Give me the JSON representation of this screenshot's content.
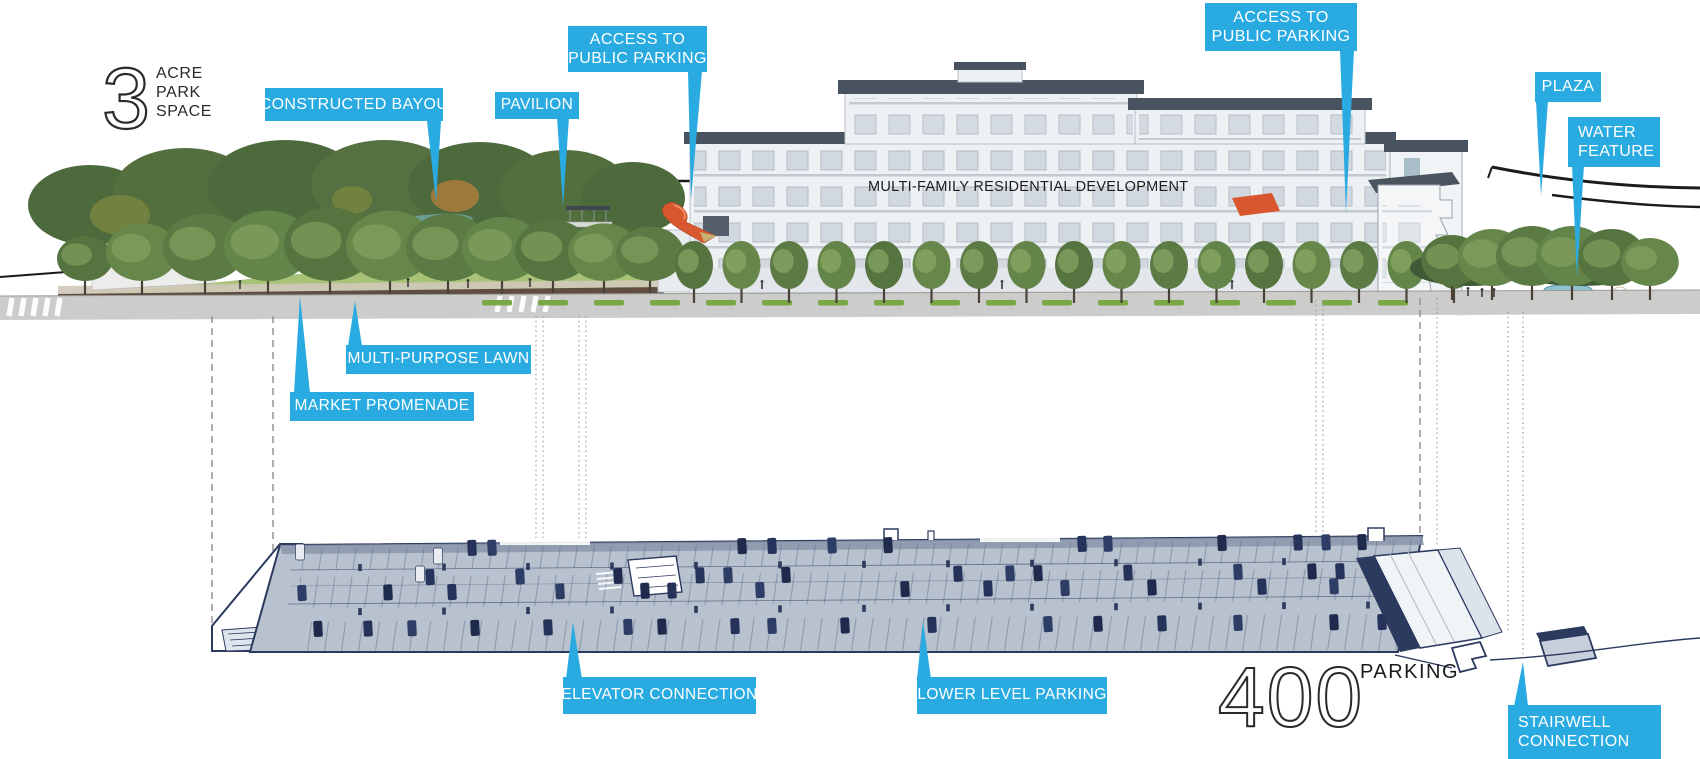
{
  "stats": {
    "acre_value": "3",
    "acre_line1": "ACRE",
    "acre_line2": "PARK",
    "acre_line3": "SPACE",
    "parking_value": "400",
    "parking_label": "PARKING"
  },
  "building": {
    "label": "MULTI-FAMILY RESIDENTIAL DEVELOPMENT"
  },
  "callouts": {
    "constructed_bayou": "CONSTRUCTED BAYOU",
    "pavilion": "PAVILION",
    "access_public_parking_left_line1": "ACCESS TO",
    "access_public_parking_left_line2": "PUBLIC PARKING",
    "access_public_parking_right_line1": "ACCESS TO",
    "access_public_parking_right_line2": "PUBLIC PARKING",
    "plaza": "PLAZA",
    "water_feature_line1": "WATER",
    "water_feature_line2": "FEATURE",
    "multi_purpose_lawn": "MULTI-PURPOSE LAWN",
    "market_promenade": "MARKET PROMENADE",
    "elevator_connection": "ELEVATOR CONNECTION",
    "lower_level_parking": "LOWER LEVEL PARKING",
    "stairwell_connection_line1": "STAIRWELL",
    "stairwell_connection_line2": "CONNECTION"
  },
  "colors": {
    "callout_blue": "#29abe2",
    "deck_navy": "#2b3a5e",
    "accent_orange": "#d9572f"
  }
}
